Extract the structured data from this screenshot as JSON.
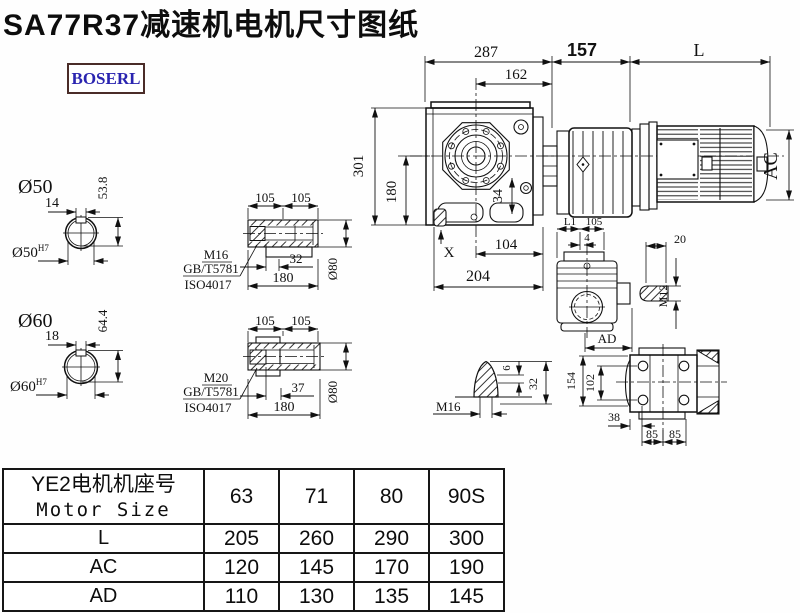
{
  "title": "SA77R37减速机电机尺寸图纸",
  "logo": {
    "text": "BOSERL"
  },
  "colors": {
    "line": "#111111",
    "logo_border": "#4a2c28",
    "logo_text": "#2a24b0",
    "background": "#fefefe"
  },
  "main_view": {
    "dim_287": "287",
    "dim_162": "162",
    "dim_157": "157",
    "dim_L": "L",
    "dim_301": "301",
    "dim_180": "180",
    "dim_104": "104",
    "dim_204": "204",
    "dim_34": "34",
    "dim_X": "X",
    "dim_AC": "AC"
  },
  "shaft50": {
    "label": "Ø50",
    "key_w": "14",
    "key_h": "53.8",
    "bore": "Ø50",
    "bore_sup": "H7"
  },
  "shaft60": {
    "label": "Ø60",
    "key_w": "18",
    "key_h": "64.4",
    "bore": "Ø60",
    "bore_sup": "H7"
  },
  "hollow1": {
    "d1": "105",
    "d2": "105",
    "thread": "M16",
    "std1": "GB/T5781",
    "std2": "ISO4017",
    "depth": "32",
    "len": "180",
    "dia": "Ø80"
  },
  "hollow2": {
    "d1": "105",
    "d2": "105",
    "thread": "M20",
    "std1": "GB/T5781",
    "std2": "ISO4017",
    "depth": "37",
    "len": "180",
    "dia": "Ø80"
  },
  "side_view": {
    "dim_L1": "L1",
    "dim_105": "105",
    "dim_4": "4",
    "dim_AD": "AD"
  },
  "key_detail": {
    "dim_20": "20",
    "thread": "M12"
  },
  "cone_detail": {
    "thread": "M16",
    "dim_6": "6",
    "dim_32": "32"
  },
  "rear_view": {
    "dim_154": "154",
    "dim_102": "102",
    "dim_38": "38",
    "dim_85a": "85",
    "dim_85b": "85"
  },
  "table": {
    "header_cn": "YE2电机机座号",
    "header_en": "Motor Size",
    "columns": [
      "63",
      "71",
      "80",
      "90S"
    ],
    "rows": [
      {
        "label": "L",
        "values": [
          "205",
          "260",
          "290",
          "300"
        ]
      },
      {
        "label": "AC",
        "values": [
          "120",
          "145",
          "170",
          "190"
        ]
      },
      {
        "label": "AD",
        "values": [
          "110",
          "130",
          "135",
          "145"
        ]
      }
    ]
  }
}
